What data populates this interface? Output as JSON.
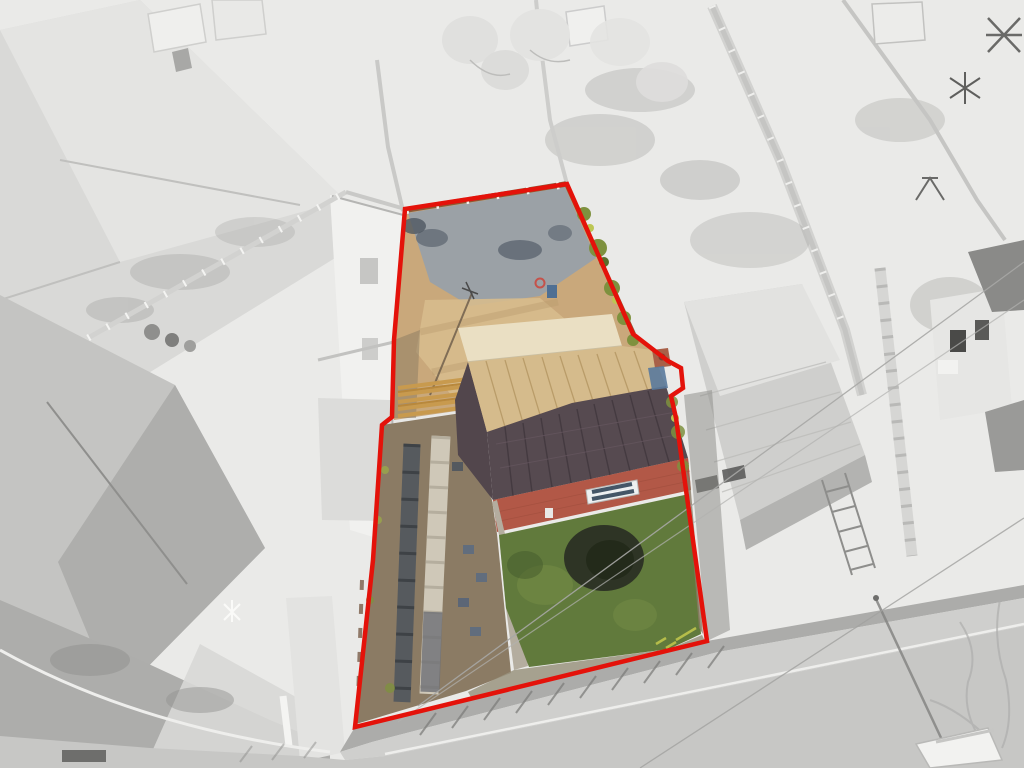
{
  "scene": {
    "description": "Grayscale aerial drone photograph of a residential street; one property plot is highlighted in full colour and outlined with a red boundary line. Inside the boundary: a sandy cleared rear garden with grey gravel, a bungalow with a dark hipped tiled roof and cream flat-roof section, red brick front wall with white window, a green lawn with a dark shrub, and a long gravel driveway with paved slab tracks leading to the road.",
    "boundary": {
      "color": "#e4120a",
      "stroke_width": 4.5,
      "points": "405,209 567,184 633,334 668,361 681,368 683,388 671,396 676,418 707,641 355,727 373,560 382,425 392,417 394,340"
    },
    "palette": {
      "backdrop": "#eaeae8",
      "road": "#c7c7c5",
      "verge": "#a5a5a3",
      "sidewalk": "#cfcfcd",
      "roof_neutral": "#cfcfcd",
      "sand_garden": "#c9a87b",
      "gravel_patch": "#96a0ab",
      "fence_brown": "#8a5a38",
      "flat_roof_cream": "#eadfc3",
      "roof_sunlit": "#d5bb8c",
      "roof_shadow": "#564a50",
      "brick_wall": "#b25847",
      "window_white": "#edf0f1",
      "lawn_green": "#617a3c",
      "bush_dark": "#2e3425",
      "drive_gravel": "#8b7b64",
      "slab_dark": "#565a5e",
      "slab_light": "#cfc8b8",
      "shrub_olive": "#7e913e",
      "chimney_brick": "#a86048",
      "tarp_blue": "#5a7a9c"
    }
  }
}
